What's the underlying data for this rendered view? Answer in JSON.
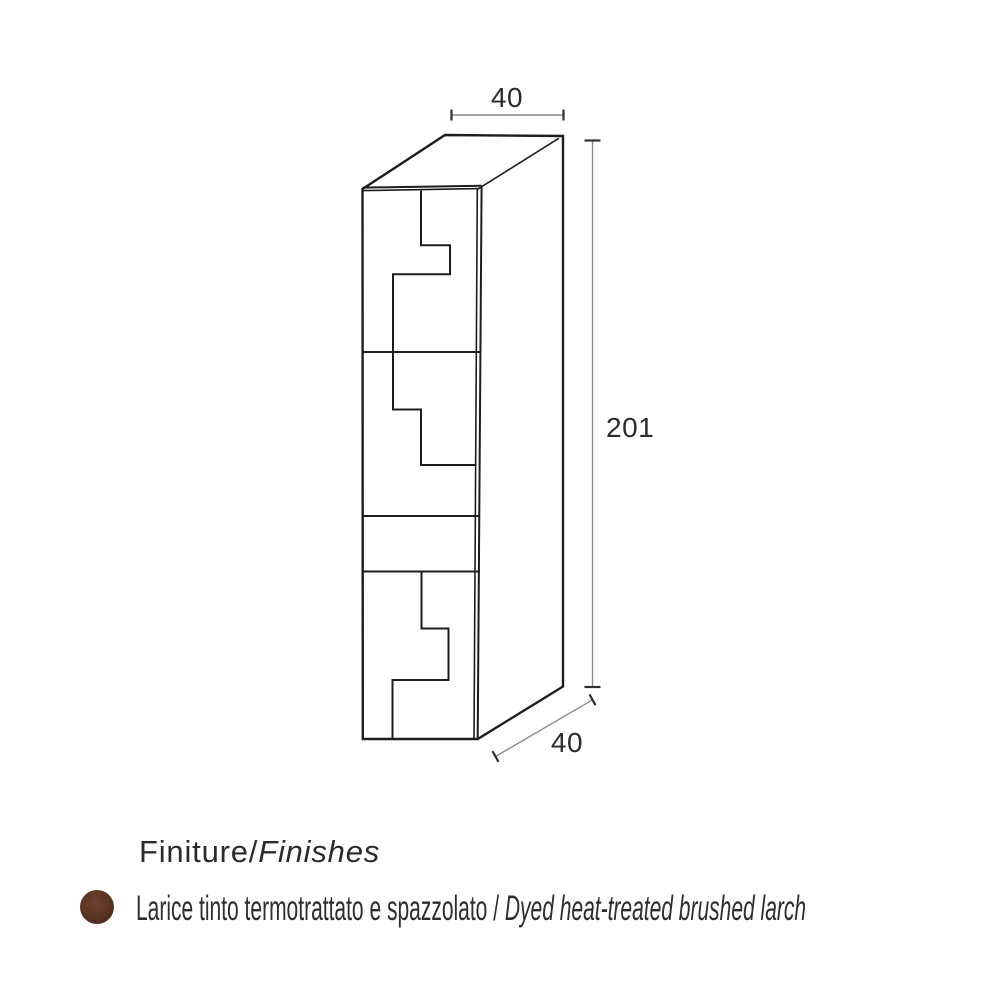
{
  "drawing": {
    "type": "axonometric technical drawing of tall column cabinet with stepped door split lines",
    "dimensions": {
      "width_top": "40",
      "height": "201",
      "depth": "40"
    },
    "colors": {
      "outline": "#1d1d1b",
      "dimension_line": "#8a8a8a",
      "dimension_tick": "#2f2f2f",
      "label_text": "#2b2b2b"
    }
  },
  "finishes": {
    "heading": {
      "primary": "Finiture",
      "separator": "/",
      "secondary": "Finishes"
    },
    "items": [
      {
        "swatch_color": "#5a3322",
        "label_it": "Larice tinto termotrattato e spazzolato",
        "separator": " / ",
        "label_en": "Dyed heat-treated brushed larch"
      }
    ]
  }
}
